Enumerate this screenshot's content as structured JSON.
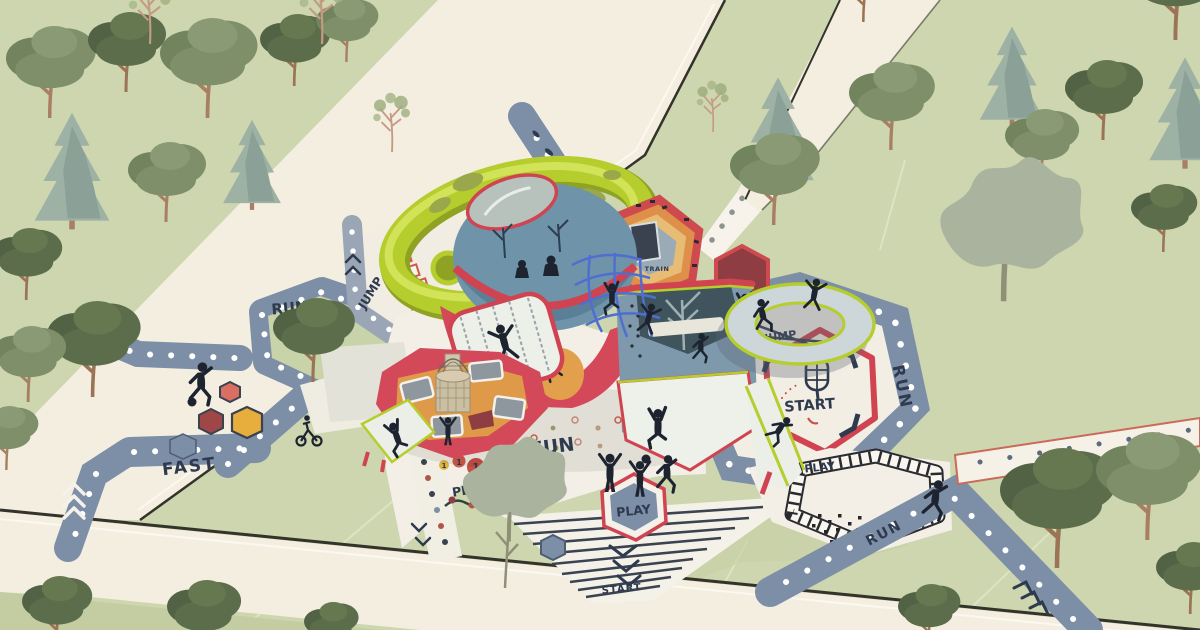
{
  "scene": {
    "type": "playground-masterplan-rendering",
    "view": "isometric aerial",
    "setting": "park with trees, cream roads and dotted play paths"
  },
  "palette": {
    "grass": "#cdd6ae",
    "grass_shade": "#c3cda1",
    "road_cream": "#f4eee1",
    "road_edge": "#33332b",
    "path_blue": "#7d8ea7",
    "path_grey": "#9aa6b6",
    "plaza_white": "#f3efe6",
    "navy": "#2e3a4e",
    "frame_red": "#d4495a",
    "maroon": "#8e3d42",
    "orange": "#de8f49",
    "yellow": "#e7ad3d",
    "lime_green": "#b5cd2d",
    "dome_blue": "#6f93a9",
    "silhouette": "#1d2430",
    "salmon": "#d96f62"
  },
  "labels": {
    "fast": "FAST",
    "run_island": "RUN",
    "jump_hopscotch": "JUMP",
    "fun": "FUN",
    "play_numbers": "PLAY",
    "play_hexagon": "PLAY",
    "start_stripes": "START",
    "run_hexagon": "RUN",
    "start_hexagon": "START",
    "jump_track": "JUMP",
    "play_maze": "PLAY",
    "run_path": "RUN",
    "train": "TRAIN"
  },
  "hopscotch_numbers": [
    "1",
    "1",
    "1",
    "4",
    "3"
  ],
  "icons": {
    "popsicle": "popsicle-start-icon",
    "chevron": "direction-chevron-icon",
    "trampoline": "trampoline-ring-icon",
    "football": "ball-icon",
    "tree": "tree-icon",
    "kid": "child-silhouette-icon",
    "confetti": "confetti-dot-icon",
    "hexagon": "hexagon-pad-icon"
  }
}
